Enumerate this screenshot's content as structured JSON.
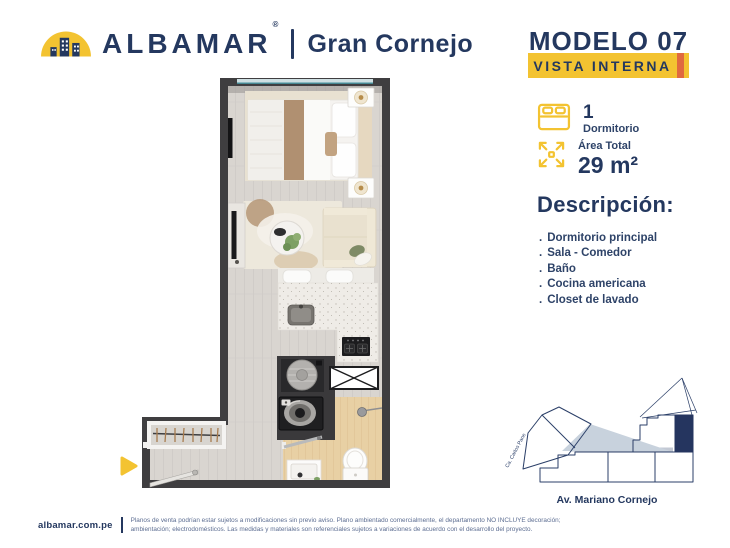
{
  "brand": {
    "name": "ALBAMAR",
    "registered": "®",
    "project": "Gran Cornejo",
    "logo_icon": "dome-skyline-icon",
    "navy": "#24385F",
    "yellow": "#F3C331",
    "orange": "#E0693F"
  },
  "header": {
    "model_title": "MODELO 07",
    "view_badge": "VISTA INTERNA"
  },
  "specs": {
    "bedrooms": {
      "icon": "bed-icon",
      "value": "1",
      "label": "Dormitorio"
    },
    "area": {
      "icon": "expand-arrows-icon",
      "label": "Área Total",
      "value": "29 m²"
    }
  },
  "description": {
    "heading": "Descripción:",
    "bullet": ".",
    "items": [
      "Dormitorio principal",
      "Sala - Comedor",
      "Baño",
      "Cocina americana",
      "Closet de lavado"
    ]
  },
  "floorplan": {
    "entrance_icon": "arrow-right-icon",
    "entrance_color": "#F3C331",
    "depicted": [
      "bed",
      "nightstands-with-lamps",
      "tv",
      "sofa",
      "coffee-table",
      "kitchen-counter-with-sink-and-stove",
      "washer",
      "bathroom-toilet-vanity-shower",
      "closet-with-hangers",
      "entry-door",
      "window-top"
    ]
  },
  "sitemap": {
    "street_left": "Ca. Carlos Pane",
    "street_bottom": "Av. Mariano Cornejo",
    "highlight_color": "#25355F",
    "shade_color": "#C8D2DD"
  },
  "footer": {
    "website": "albamar.com.pe",
    "disclaimer_line1": "Planos de venta podrían estar sujetos a modificaciones sin previo aviso. Plano ambientado comercialmente, el departamento NO INCLUYE decoración;",
    "disclaimer_line2": "ambientación; electrodomésticos. Las medidas y materiales son referenciales sujetos a variaciones de acuerdo con el desarrollo del proyecto."
  }
}
